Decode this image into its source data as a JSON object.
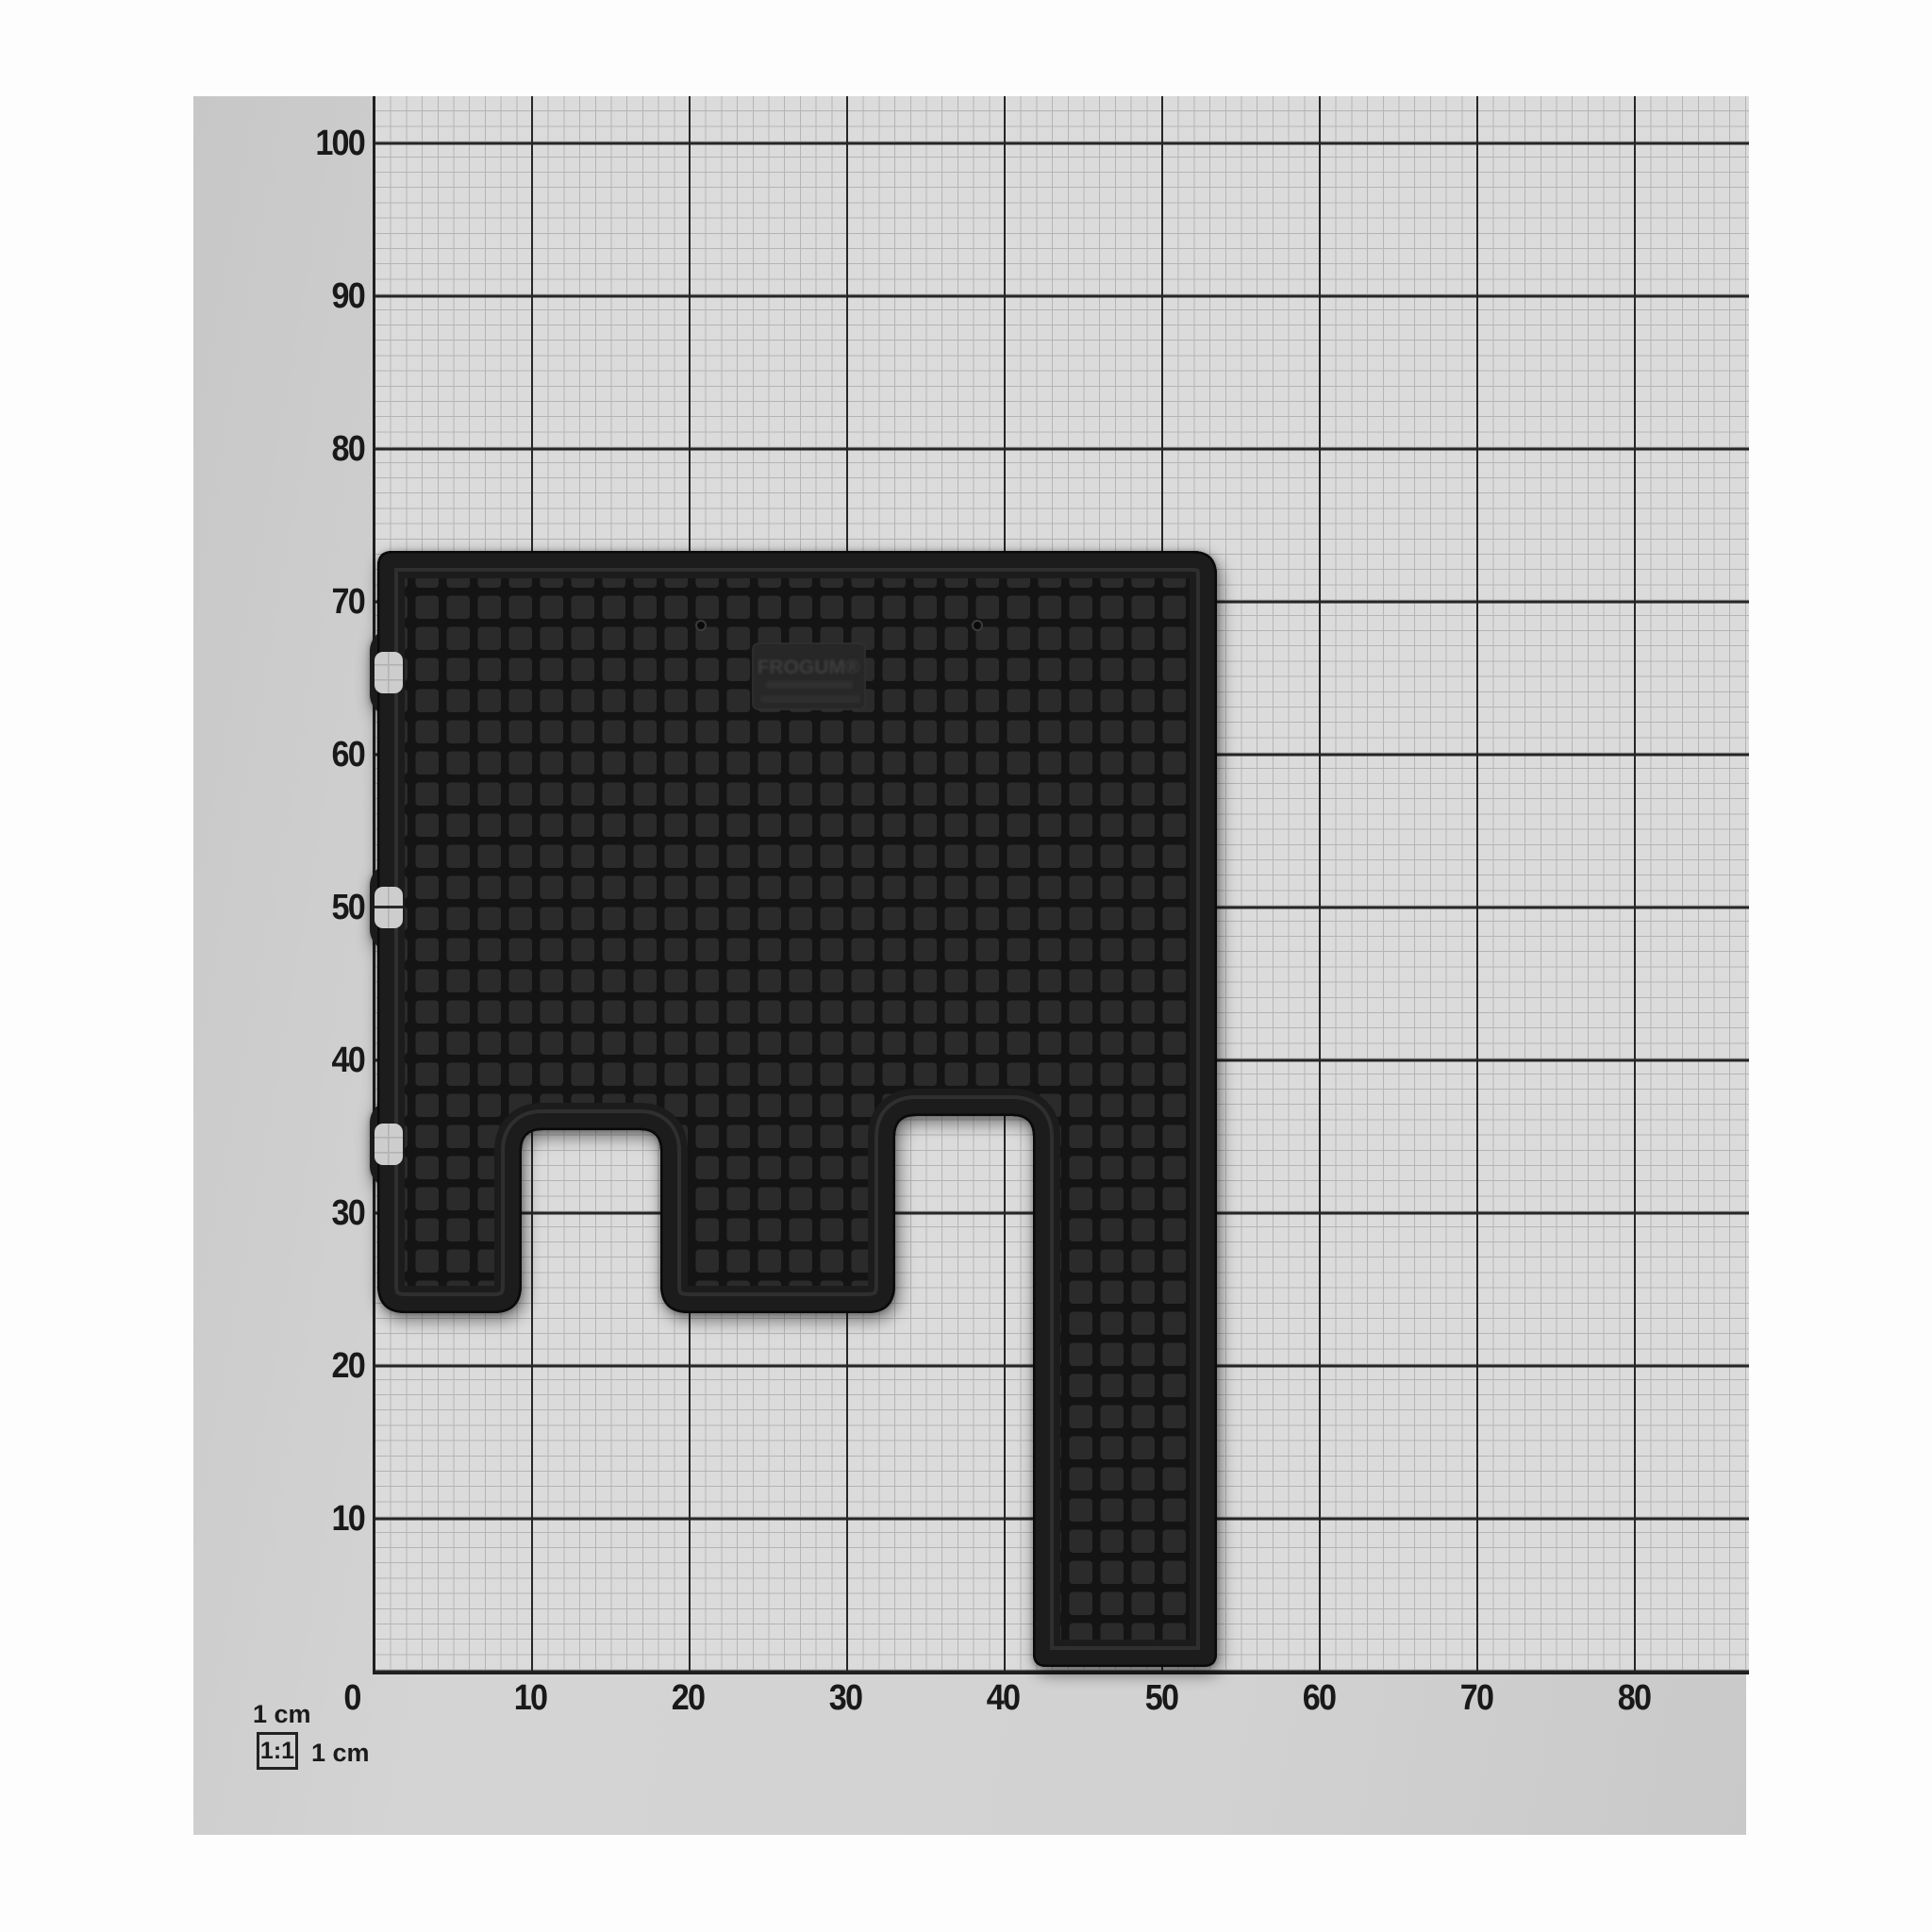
{
  "subject": {
    "description": "Black rubber car floor mat photographed flat on a centimetre measurement grid board"
  },
  "measurement_board": {
    "legend": {
      "unit_top": "1 cm",
      "scale_ratio": "1:1",
      "unit_side": "1 cm"
    },
    "y_axis_tick_labels": [
      "100",
      "90",
      "80",
      "70",
      "60",
      "50",
      "40",
      "30",
      "20",
      "10"
    ],
    "x_axis_tick_labels": [
      "0",
      "10",
      "20",
      "30",
      "40",
      "50",
      "60",
      "70",
      "80"
    ],
    "grid_minor_step_cm": 1,
    "grid_major_step_cm": 10
  },
  "mat": {
    "stamp_brand": "FROGUM®"
  },
  "colors": {
    "background": "#fdfdfd",
    "paper": "#d2d2d2",
    "grid_area": "#dbdbdb",
    "minor_line": "#b4b4b4",
    "major_line": "#262626",
    "label_text": "#191919",
    "mat_base": "#181818",
    "mat_cell": "#2b2b2b",
    "mat_rim": "#2f2f2f",
    "hook_window": "#cdcdcd"
  }
}
